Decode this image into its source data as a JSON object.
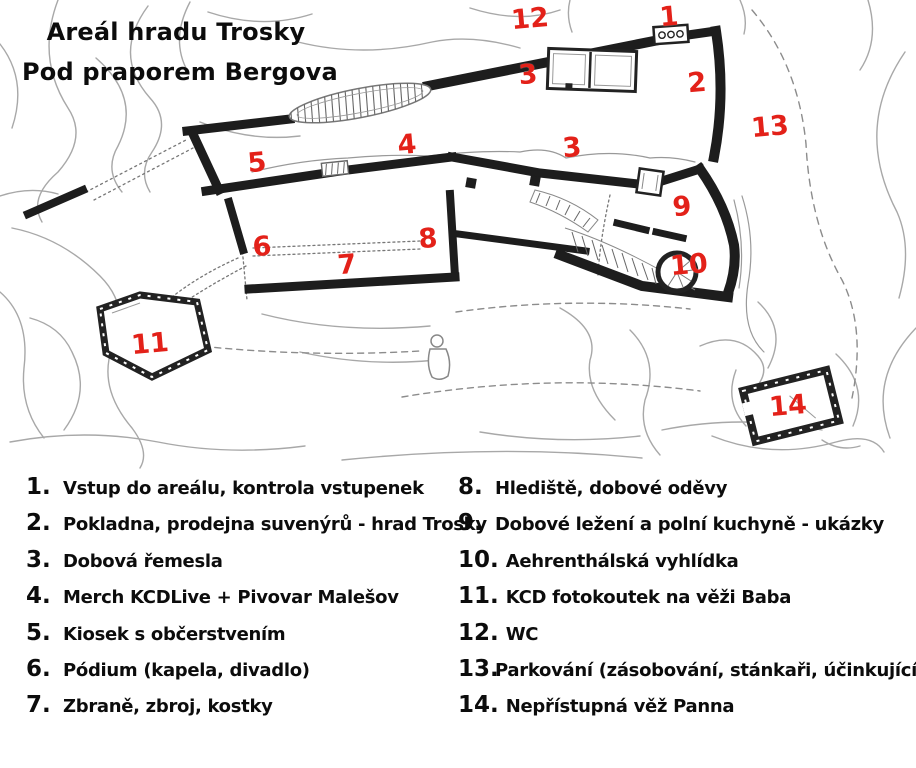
{
  "title": {
    "line1": "Areál hradu Trosky",
    "line2": "Pod praporem Bergova"
  },
  "map": {
    "marker_color": "#e32119",
    "markers": [
      {
        "label": "1",
        "x": 669,
        "y": 17
      },
      {
        "label": "2",
        "x": 697,
        "y": 83
      },
      {
        "label": "3",
        "x": 528,
        "y": 75
      },
      {
        "label": "3",
        "x": 572,
        "y": 148
      },
      {
        "label": "4",
        "x": 407,
        "y": 145
      },
      {
        "label": "5",
        "x": 257,
        "y": 163
      },
      {
        "label": "6",
        "x": 262,
        "y": 247
      },
      {
        "label": "7",
        "x": 347,
        "y": 265
      },
      {
        "label": "8",
        "x": 428,
        "y": 239
      },
      {
        "label": "9",
        "x": 682,
        "y": 207
      },
      {
        "label": "10",
        "x": 689,
        "y": 265
      },
      {
        "label": "11",
        "x": 150,
        "y": 344
      },
      {
        "label": "12",
        "x": 530,
        "y": 19
      },
      {
        "label": "13",
        "x": 770,
        "y": 127
      },
      {
        "label": "14",
        "x": 788,
        "y": 406
      }
    ]
  },
  "legend": {
    "left": [
      {
        "num": "1.",
        "label": "Vstup do areálu, kontrola vstupenek"
      },
      {
        "num": "2.",
        "label": "Pokladna, prodejna suvenýrů - hrad Trosky"
      },
      {
        "num": "3.",
        "label": "Dobová řemesla"
      },
      {
        "num": "4.",
        "label": "Merch KCDLive + Pivovar Malešov"
      },
      {
        "num": "5.",
        "label": "Kiosek s občerstvením"
      },
      {
        "num": "6.",
        "label": "Pódium (kapela, divadlo)"
      },
      {
        "num": "7.",
        "label": "Zbraně, zbroj, kostky"
      }
    ],
    "right": [
      {
        "num": "8.",
        "label": "Hlediště, dobové oděvy"
      },
      {
        "num": "9.",
        "label": "Dobové ležení a polní kuchyně - ukázky"
      },
      {
        "num": "10.",
        "label": "Aehrenthálská vyhlídka"
      },
      {
        "num": "11.",
        "label": "KCD fotokoutek na věži Baba"
      },
      {
        "num": "12.",
        "label": "WC"
      },
      {
        "num": "13.",
        "label": "Parkování (zásobování, stánkaři, účinkující)"
      },
      {
        "num": "14.",
        "label": "Nepřístupná věž Panna"
      }
    ]
  }
}
